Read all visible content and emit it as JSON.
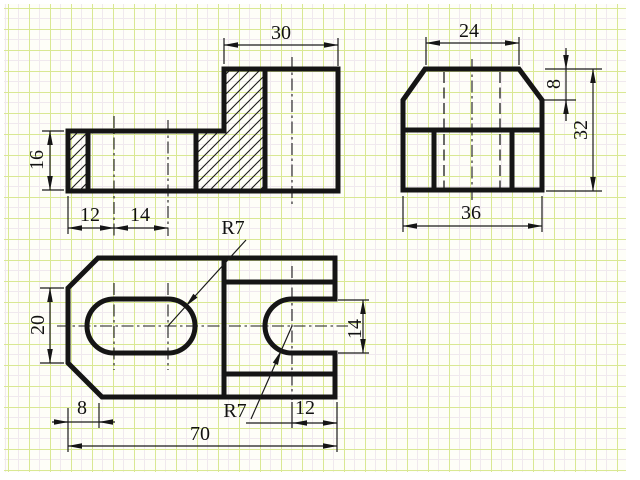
{
  "colors": {
    "paper": "#ffffff",
    "grid_line": "#d9e893",
    "grid_minor": "#f0e9ee",
    "ink": "#151515"
  },
  "labels": {
    "front_height": "16",
    "front_hole_offset": "12",
    "front_hole_pitch": "14",
    "front_boss_width": "30",
    "side_top_width": "24",
    "side_chamfer_height": "8",
    "side_total_height": "32",
    "side_width": "36",
    "plan_slot_radius": "R7",
    "plan_width": "20",
    "plan_chamfer": "8",
    "plan_notch_radius": "R7",
    "plan_notch_depth": "12",
    "plan_length": "70",
    "plan_notch_width": "14"
  }
}
